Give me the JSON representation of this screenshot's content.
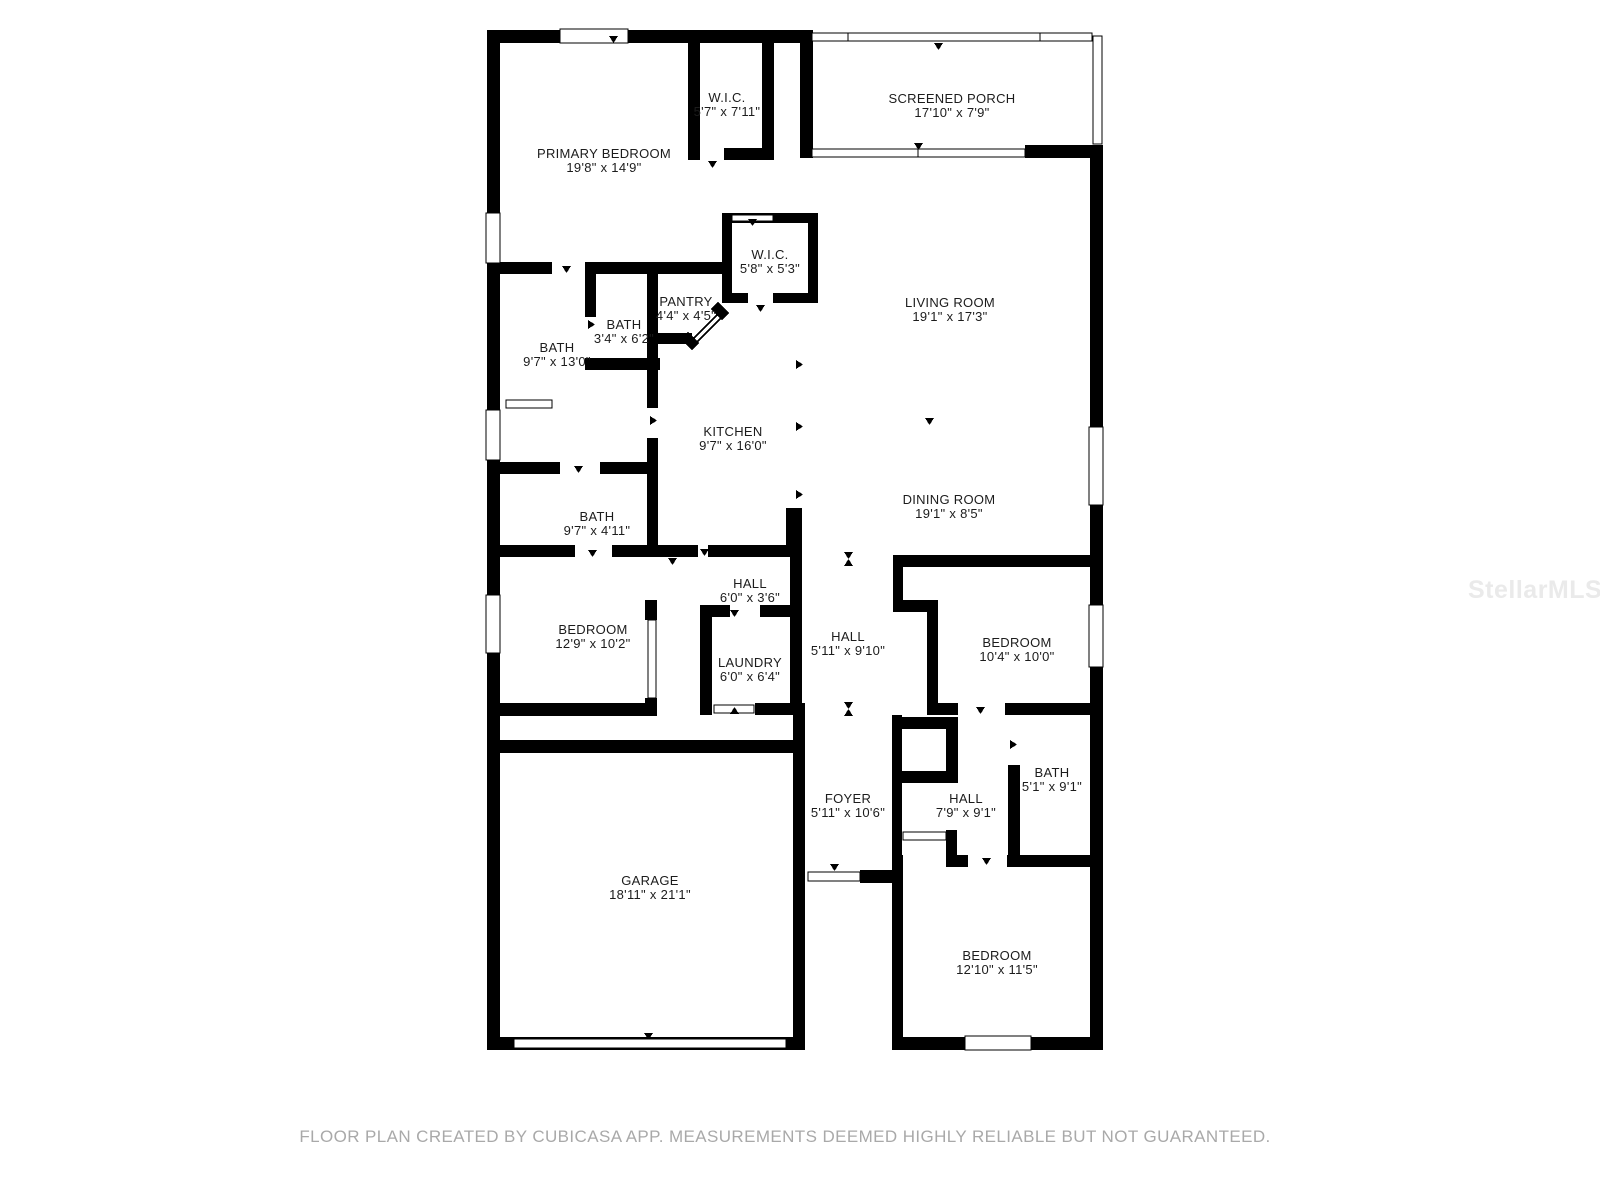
{
  "watermark": "StellarMLS",
  "footer": "FLOOR PLAN CREATED BY CUBICASA APP. MEASUREMENTS DEEMED HIGHLY RELIABLE BUT NOT GUARANTEED.",
  "colors": {
    "wall": "#000000",
    "label": "#1c1c1c",
    "footer": "#a9a9a9",
    "watermark": "#eaeaea",
    "background": "#ffffff"
  },
  "rooms": [
    {
      "name": "PRIMARY BEDROOM",
      "dims": "19'8\" x 14'9\""
    },
    {
      "name": "W.I.C.",
      "dims": "5'7\" x 7'11\""
    },
    {
      "name": "SCREENED PORCH",
      "dims": "17'10\" x 7'9\""
    },
    {
      "name": "W.I.C.",
      "dims": "5'8\" x 5'3\""
    },
    {
      "name": "PANTRY",
      "dims": "4'4\" x 4'5\""
    },
    {
      "name": "BATH",
      "dims": "3'4\" x 6'2\""
    },
    {
      "name": "BATH",
      "dims": "9'7\" x 13'0\""
    },
    {
      "name": "LIVING ROOM",
      "dims": "19'1\" x 17'3\""
    },
    {
      "name": "KITCHEN",
      "dims": "9'7\" x 16'0\""
    },
    {
      "name": "DINING ROOM",
      "dims": "19'1\" x 8'5\""
    },
    {
      "name": "BATH",
      "dims": "9'7\" x 4'11\""
    },
    {
      "name": "HALL",
      "dims": "6'0\" x 3'6\""
    },
    {
      "name": "BEDROOM",
      "dims": "12'9\" x 10'2\""
    },
    {
      "name": "LAUNDRY",
      "dims": "6'0\" x 6'4\""
    },
    {
      "name": "HALL",
      "dims": "5'11\" x 9'10\""
    },
    {
      "name": "BEDROOM",
      "dims": "10'4\" x 10'0\""
    },
    {
      "name": "BATH",
      "dims": "5'1\" x 9'1\""
    },
    {
      "name": "FOYER",
      "dims": "5'11\" x 10'6\""
    },
    {
      "name": "HALL",
      "dims": "7'9\" x 9'1\""
    },
    {
      "name": "GARAGE",
      "dims": "18'11\" x 21'1\""
    },
    {
      "name": "BEDROOM",
      "dims": "12'10\" x 11'5\""
    }
  ]
}
